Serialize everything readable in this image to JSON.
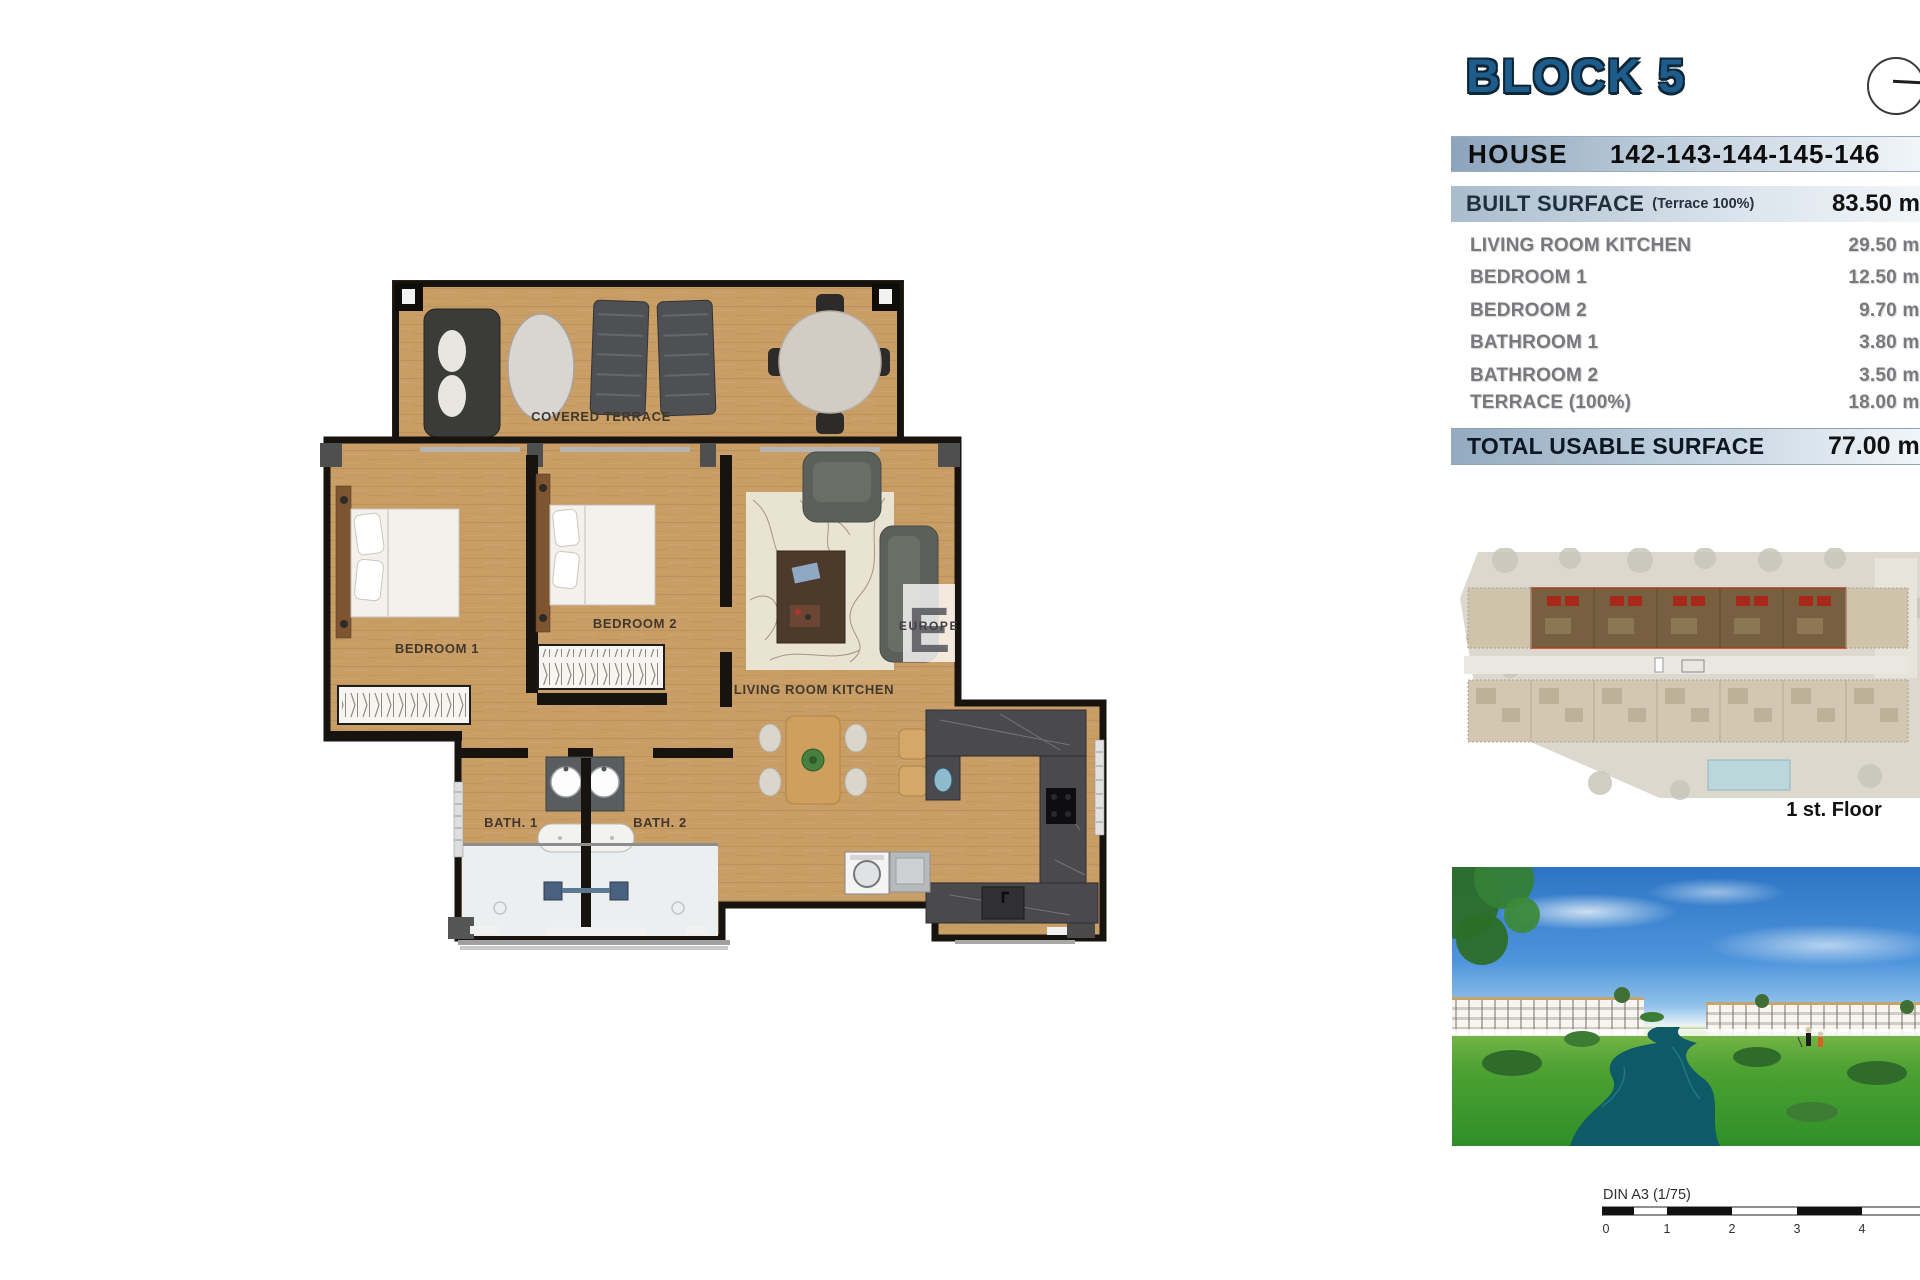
{
  "header": {
    "block_title": "BLOCK 5",
    "house_label": "HOUSE",
    "house_numbers": "142-143-144-145-146",
    "built_surface_label": "BUILT SURFACE",
    "built_surface_note": "(Terrace 100%)",
    "built_surface_value": "83.50 m²",
    "rows": [
      {
        "label": "LIVING ROOM KITCHEN",
        "value": "29.50 m²"
      },
      {
        "label": "BEDROOM 1",
        "value": "12.50 m²"
      },
      {
        "label": "BEDROOM 2",
        "value": "9.70 m²"
      },
      {
        "label": "BATHROOM 1",
        "value": "3.80 m²"
      },
      {
        "label": "BATHROOM 2",
        "value": "3.50 m²"
      },
      {
        "label": "TERRACE (100%)",
        "value": "18.00 m²"
      }
    ],
    "total_label": "TOTAL USABLE SURFACE",
    "total_value": "77.00 m²"
  },
  "floor_plan": {
    "labels": {
      "covered_terrace": "COVERED TERRACE",
      "bedroom1": "BEDROOM 1",
      "bedroom2": "BEDROOM 2",
      "living": "LIVING ROOM KITCHEN",
      "bath1": "BATH. 1",
      "bath2": "BATH. 2"
    },
    "watermark_letter": "E",
    "watermark_word": "EUROPE"
  },
  "site_plan": {
    "caption": "1 st. Floor"
  },
  "scale_bar": {
    "label": "DIN A3 (1/75)",
    "ticks": [
      "0",
      "1",
      "2",
      "3",
      "4"
    ]
  },
  "colors": {
    "accent_blue": "#1e5c8b",
    "bar_gradient_start": "#8ca4bc",
    "highlight_red": "#b23b20",
    "wood": "#c99e66",
    "water": "#0e5a66"
  }
}
